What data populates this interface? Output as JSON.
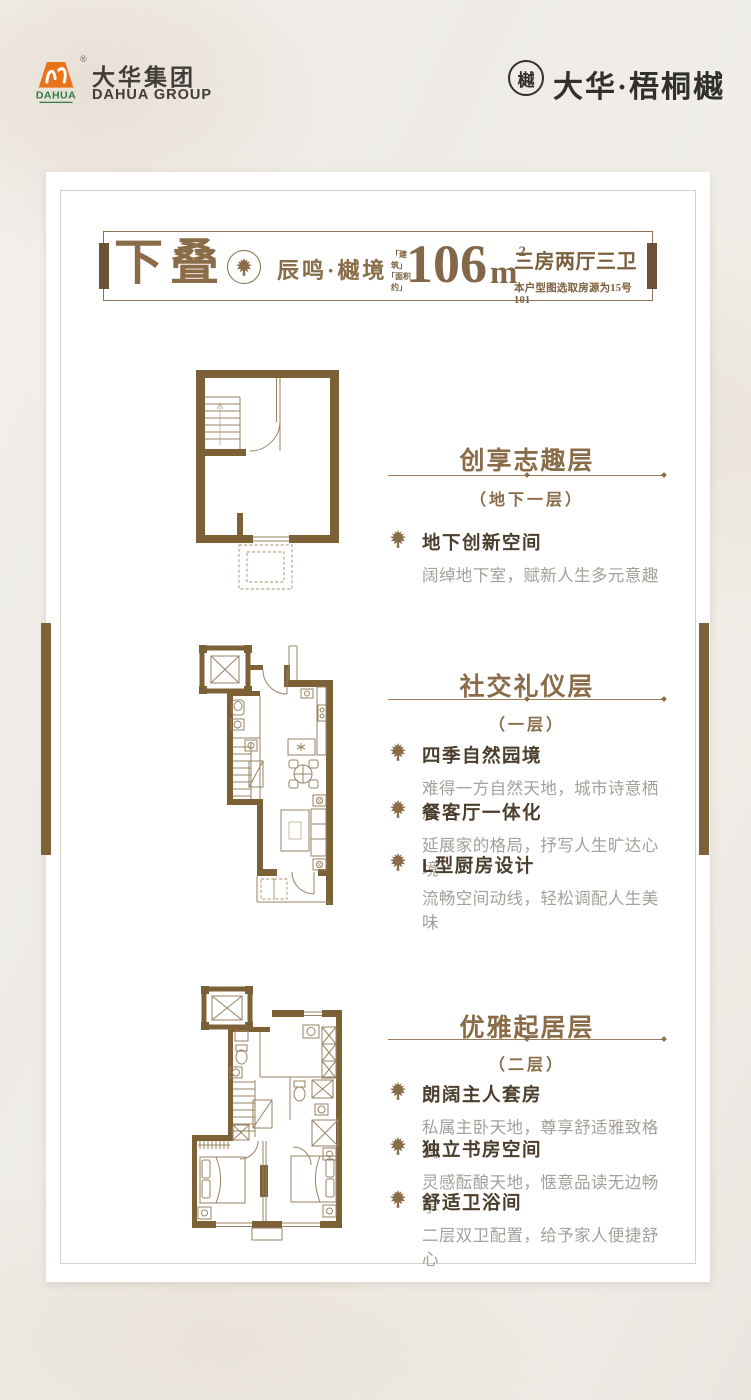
{
  "brand": {
    "group_logo": {
      "icon_text": "DAHUA",
      "reg": "®",
      "cn": "大华集团",
      "en": "DAHUA GROUP"
    },
    "project_logo": {
      "seal_char": "樾",
      "name": "大华·梧桐樾"
    }
  },
  "titlebar": {
    "product": "下叠",
    "series": "辰鸣·樾境",
    "area_label_top": "「建 筑」",
    "area_label_bottom": "「面积约」",
    "area_value": "106",
    "area_unit": "m",
    "area_exp": "2",
    "rooms": "三房两厅三卫",
    "note": "本户型图选取房源为15号101"
  },
  "sections": [
    {
      "title": "创享志趣层",
      "floor": "（地下一层）",
      "bullets": [
        {
          "title": "地下创新空间",
          "desc": "阔绰地下室，赋新人生多元意趣"
        }
      ]
    },
    {
      "title": "社交礼仪层",
      "floor": "（一层）",
      "bullets": [
        {
          "title": "四季自然园境",
          "desc": "难得一方自然天地，城市诗意栖居"
        },
        {
          "title": "餐客厅一体化",
          "desc": "延展家的格局，抒写人生旷达心境"
        },
        {
          "title": "L型厨房设计",
          "desc": "流畅空间动线，轻松调配人生美味"
        }
      ]
    },
    {
      "title": "优雅起居层",
      "floor": "（二层）",
      "bullets": [
        {
          "title": "朗阔主人套房",
          "desc": "私属主卧天地，尊享舒适雅致格调"
        },
        {
          "title": "独立书房空间",
          "desc": "灵感酝酿天地，惬意品读无边畅享"
        },
        {
          "title": "舒适卫浴间",
          "desc": "二层双卫配置，给予家人便捷舒心"
        }
      ]
    }
  ],
  "icons": {
    "bullet_icon": "maple-leaf",
    "header_badge": "maple-leaf-in-circle",
    "project_badge": "circular-seal"
  },
  "colors": {
    "accent_brown": "#8a6c48",
    "dark_brown": "#6b5333",
    "wall_brown": "#7c6137",
    "feature_title": "#4b3e2d",
    "desc_gray": "#a5a09a",
    "logo_orange": "#e8731b",
    "logo_green": "#2e7d46",
    "ink": "#34302a"
  }
}
